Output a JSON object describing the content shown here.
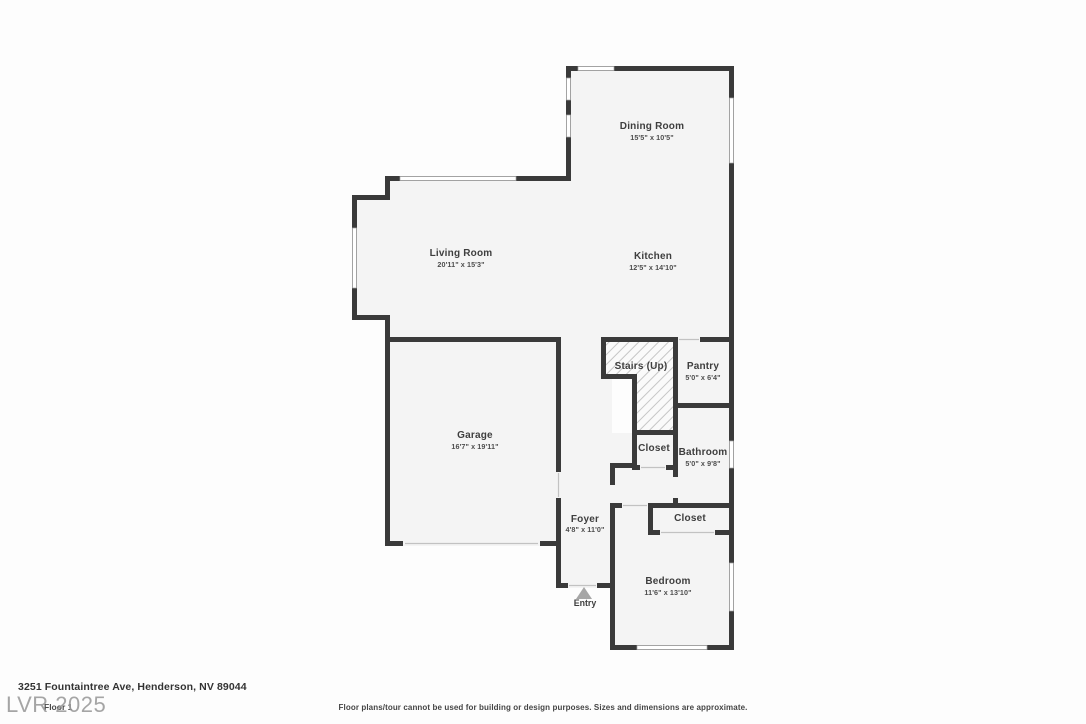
{
  "plan": {
    "rooms": [
      {
        "name": "Dining Room",
        "dims": "15'5\" x 10'5\""
      },
      {
        "name": "Living Room",
        "dims": "20'11\" x 15'3\""
      },
      {
        "name": "Kitchen",
        "dims": "12'5\" x 14'10\""
      },
      {
        "name": "Garage",
        "dims": "16'7\" x 19'11\""
      },
      {
        "name": "Stairs (Up)",
        "dims": ""
      },
      {
        "name": "Pantry",
        "dims": "5'0\" x 6'4\""
      },
      {
        "name": "Closet",
        "dims": ""
      },
      {
        "name": "Bathroom",
        "dims": "5'0\" x 9'8\""
      },
      {
        "name": "Foyer",
        "dims": "4'8\" x 11'0\""
      },
      {
        "name": "Closet",
        "dims": ""
      },
      {
        "name": "Bedroom",
        "dims": "11'6\" x 13'10\""
      }
    ],
    "entry_label": "Entry",
    "colors": {
      "wall": "#3a3a3a",
      "floor": "#f4f4f4",
      "window": "#ffffff",
      "entry_arrow": "#a6a6a6",
      "watermark": "#9a9a9a"
    }
  },
  "footer": {
    "address": "3251 Fountaintree Ave, Henderson, NV 89044",
    "floor_label": "Floor 1",
    "watermark": "LVR 2025",
    "disclaimer": "Floor plans/tour cannot be used for building or design purposes. Sizes and dimensions are approximate."
  }
}
